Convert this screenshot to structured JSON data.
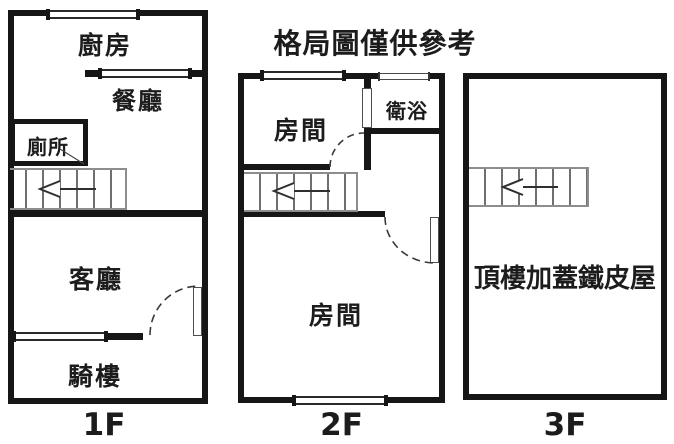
{
  "title": "格局圖僅供參考",
  "floor_1f": {
    "label": "1F",
    "kitchen": "廚房",
    "dining": "餐廳",
    "toilet": "廁所",
    "living": "客廳",
    "arcade": "騎樓"
  },
  "floor_2f": {
    "label": "2F",
    "bedroom_upper": "房間",
    "bathroom": "衛浴",
    "bedroom_main": "房間"
  },
  "floor_3f": {
    "label": "3F",
    "rooftop": "頂樓加蓋鐵皮屋"
  },
  "colors": {
    "wall": "#161616",
    "background": "#ffffff",
    "stair_line": "#6f6f6f",
    "stair_border": "#8d8d8d",
    "text": "#1c1c1c"
  }
}
